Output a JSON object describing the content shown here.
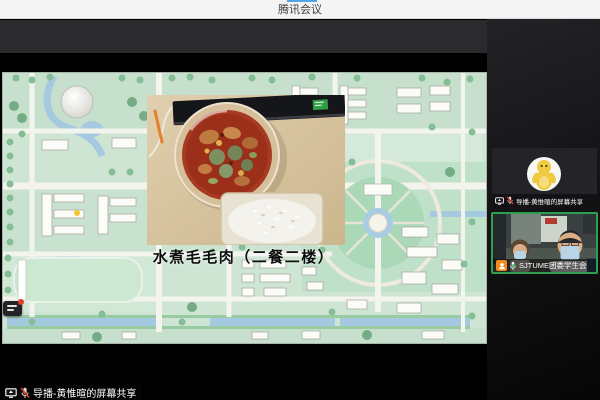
{
  "window": {
    "title": "腾讯会议"
  },
  "shared_screen": {
    "caption": "水煮毛毛肉（二餐二楼）",
    "presenter_label": "导播-黄惟暄的屏幕共享"
  },
  "participants": [
    {
      "name": "导播-黄惟暄的屏幕共享",
      "mic": "muted",
      "sharing": true,
      "speaking": false
    },
    {
      "name": "SJTUME团委学生会",
      "mic": "on",
      "sharing": false,
      "speaking": true
    }
  ],
  "colors": {
    "accent_blue": "#53a3e9",
    "speaking_border_green": "#2f9e4f",
    "muted_red": "#e23b2e",
    "member_badge_orange": "#f08c1e"
  }
}
